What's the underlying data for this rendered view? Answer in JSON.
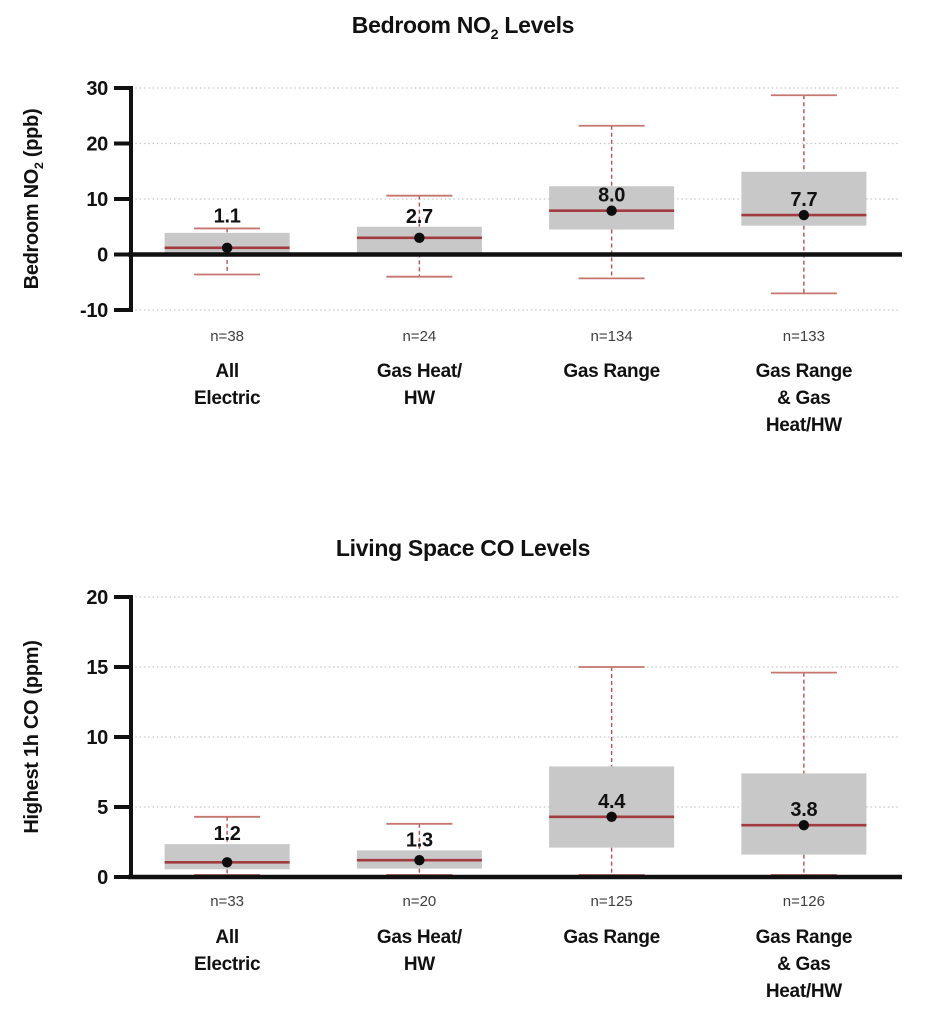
{
  "figure_title": "Bedroom NO2 and Living Space CO box plots",
  "colors": {
    "background": "#ffffff",
    "box_fill": "#c8c8c8",
    "median_line": "#a23b3f",
    "whisker_dash": "#b5534d",
    "whisker_cap": "#c4766f",
    "grid_line": "#c6c6c6",
    "axis_line": "#111111",
    "mean_dot": "#0d0d0d",
    "n_label_text": "#3f3f3f",
    "label_text": "#111111"
  },
  "chart_data": [
    {
      "type": "box",
      "title_segments": [
        {
          "text": "Bedroom NO"
        },
        {
          "text": "2",
          "sub": true
        },
        {
          "text": " Levels"
        }
      ],
      "ylabel_segments": [
        {
          "text": "Bedroom NO"
        },
        {
          "text": "2",
          "sub": true
        },
        {
          "text": " (ppb)"
        }
      ],
      "ylim": [
        -10,
        30
      ],
      "yticks": [
        30,
        20,
        10,
        0,
        -10
      ],
      "zero_line_value": 0,
      "grid": true,
      "categories": [
        {
          "name_lines": [
            "All",
            "Electric"
          ],
          "n_label": "n=38",
          "display_value": "1.1",
          "stats": {
            "whisker_low": -3.6,
            "q1": 0.3,
            "median": 1.2,
            "mean": 1.1,
            "q3": 3.9,
            "whisker_high": 4.7
          }
        },
        {
          "name_lines": [
            "Gas Heat/",
            "HW"
          ],
          "n_label": "n=24",
          "display_value": "2.7",
          "stats": {
            "whisker_low": -4.0,
            "q1": 0.2,
            "median": 3.0,
            "mean": 2.7,
            "q3": 5.0,
            "whisker_high": 10.6
          }
        },
        {
          "name_lines": [
            "Gas Range"
          ],
          "n_label": "n=134",
          "display_value": "8.0",
          "stats": {
            "whisker_low": -4.3,
            "q1": 4.5,
            "median": 7.9,
            "mean": 8.0,
            "q3": 12.3,
            "whisker_high": 23.2
          }
        },
        {
          "name_lines": [
            "Gas Range",
            "& Gas",
            "Heat/HW"
          ],
          "n_label": "n=133",
          "display_value": "7.7",
          "stats": {
            "whisker_low": -7.0,
            "q1": 5.2,
            "median": 7.1,
            "mean": 7.7,
            "q3": 14.9,
            "whisker_high": 28.7
          }
        }
      ]
    },
    {
      "type": "box",
      "title_segments": [
        {
          "text": "Living Space CO Levels"
        }
      ],
      "ylabel_segments": [
        {
          "text": "Highest 1h CO (ppm)"
        }
      ],
      "ylim": [
        0,
        20
      ],
      "yticks": [
        20,
        15,
        10,
        5,
        0
      ],
      "zero_line_value": 0,
      "grid": true,
      "categories": [
        {
          "name_lines": [
            "All",
            "Electric"
          ],
          "n_label": "n=33",
          "display_value": "1.2",
          "stats": {
            "whisker_low": 0.15,
            "q1": 0.55,
            "median": 1.05,
            "mean": 1.2,
            "q3": 2.35,
            "whisker_high": 4.3
          }
        },
        {
          "name_lines": [
            "Gas Heat/",
            "HW"
          ],
          "n_label": "n=20",
          "display_value": "1.3",
          "stats": {
            "whisker_low": 0.15,
            "q1": 0.6,
            "median": 1.2,
            "mean": 1.3,
            "q3": 1.9,
            "whisker_high": 3.8
          }
        },
        {
          "name_lines": [
            "Gas Range"
          ],
          "n_label": "n=125",
          "display_value": "4.4",
          "stats": {
            "whisker_low": 0.15,
            "q1": 2.1,
            "median": 4.3,
            "mean": 4.4,
            "q3": 7.9,
            "whisker_high": 15.0
          }
        },
        {
          "name_lines": [
            "Gas Range",
            "& Gas",
            "Heat/HW"
          ],
          "n_label": "n=126",
          "display_value": "3.8",
          "stats": {
            "whisker_low": 0.15,
            "q1": 1.6,
            "median": 3.7,
            "mean": 3.8,
            "q3": 7.4,
            "whisker_high": 14.6
          }
        }
      ]
    }
  ]
}
